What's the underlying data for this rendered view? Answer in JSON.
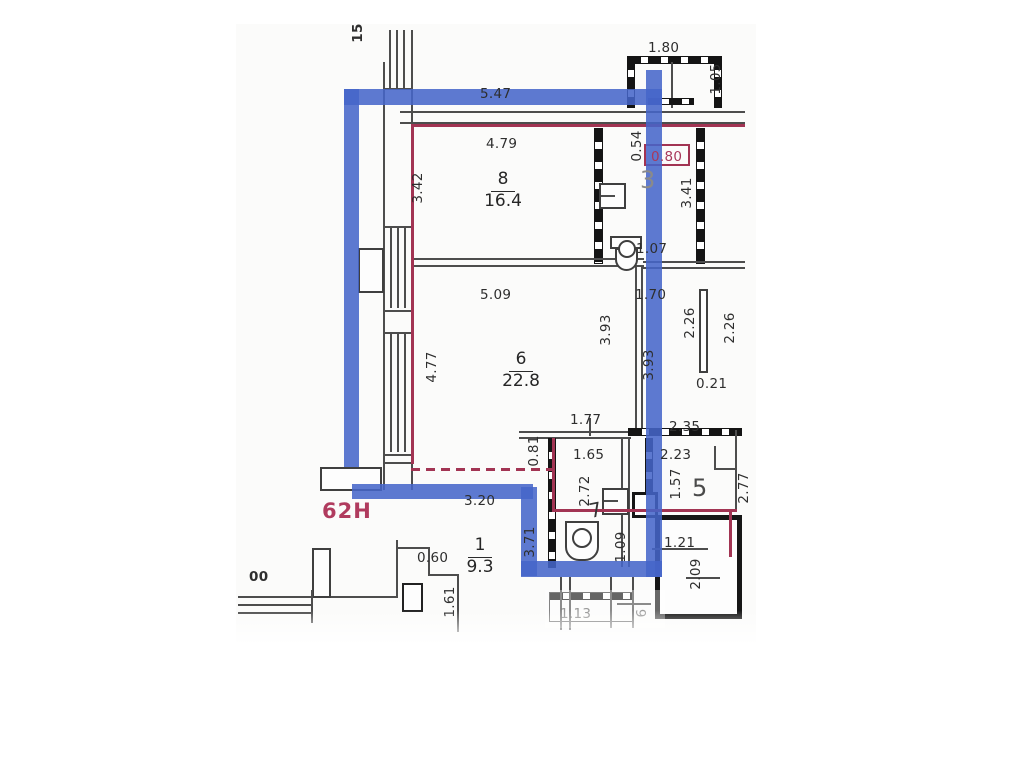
{
  "plan": {
    "type": "floor-plan",
    "unit_label": "62Н",
    "notes": {
      "top_left_partial": "15",
      "bottom_left_partial": "00",
      "bottom_partial": "6"
    },
    "colors": {
      "highlight_blue": "#4565c9",
      "boundary_red": "#a23453",
      "wall_black": "#141414",
      "wall_gray": "#4d4d4d",
      "text": "#2e2e2e",
      "room3_number_gray": "#8a8a8a"
    },
    "rooms": [
      {
        "number": "8",
        "area": "16.4"
      },
      {
        "number": "6",
        "area": "22.8"
      },
      {
        "number": "1",
        "area": "9.3"
      },
      {
        "number": "3",
        "area": ""
      },
      {
        "number": "5",
        "area": ""
      },
      {
        "number": "7",
        "area": ""
      }
    ],
    "dimensions": {
      "blue_top": "5.47",
      "balcony_w": "1.80",
      "balcony_d": "1.05",
      "r8_w": "4.79",
      "r8_h": "3.42",
      "shaft_h": "0.54",
      "shaft_w": "0.80",
      "r3_h": "3.41",
      "r3_wc": "1.07",
      "r6_w": "5.09",
      "r6_h": "4.77",
      "hall_w": "1.70",
      "r6_right": "3.93",
      "blue_right": "3.93",
      "ward_a": "2.26",
      "ward_b": "2.26",
      "part_w": "0.21",
      "bath_top": "1.77",
      "niche_h": "0.81",
      "bath_w": "1.65",
      "bath_h": "2.72",
      "hall5": "2.35",
      "r5_w": "2.23",
      "r5_hl": "1.57",
      "r5_hr": "2.77",
      "blue_bottom": "3.20",
      "blue_bl_v": "3.71",
      "bath_b": "1.09",
      "door_b": "1.21",
      "step": "0.60",
      "r1_l": "1.61",
      "shaft_b": "2.09",
      "win_b": "1.13"
    }
  }
}
